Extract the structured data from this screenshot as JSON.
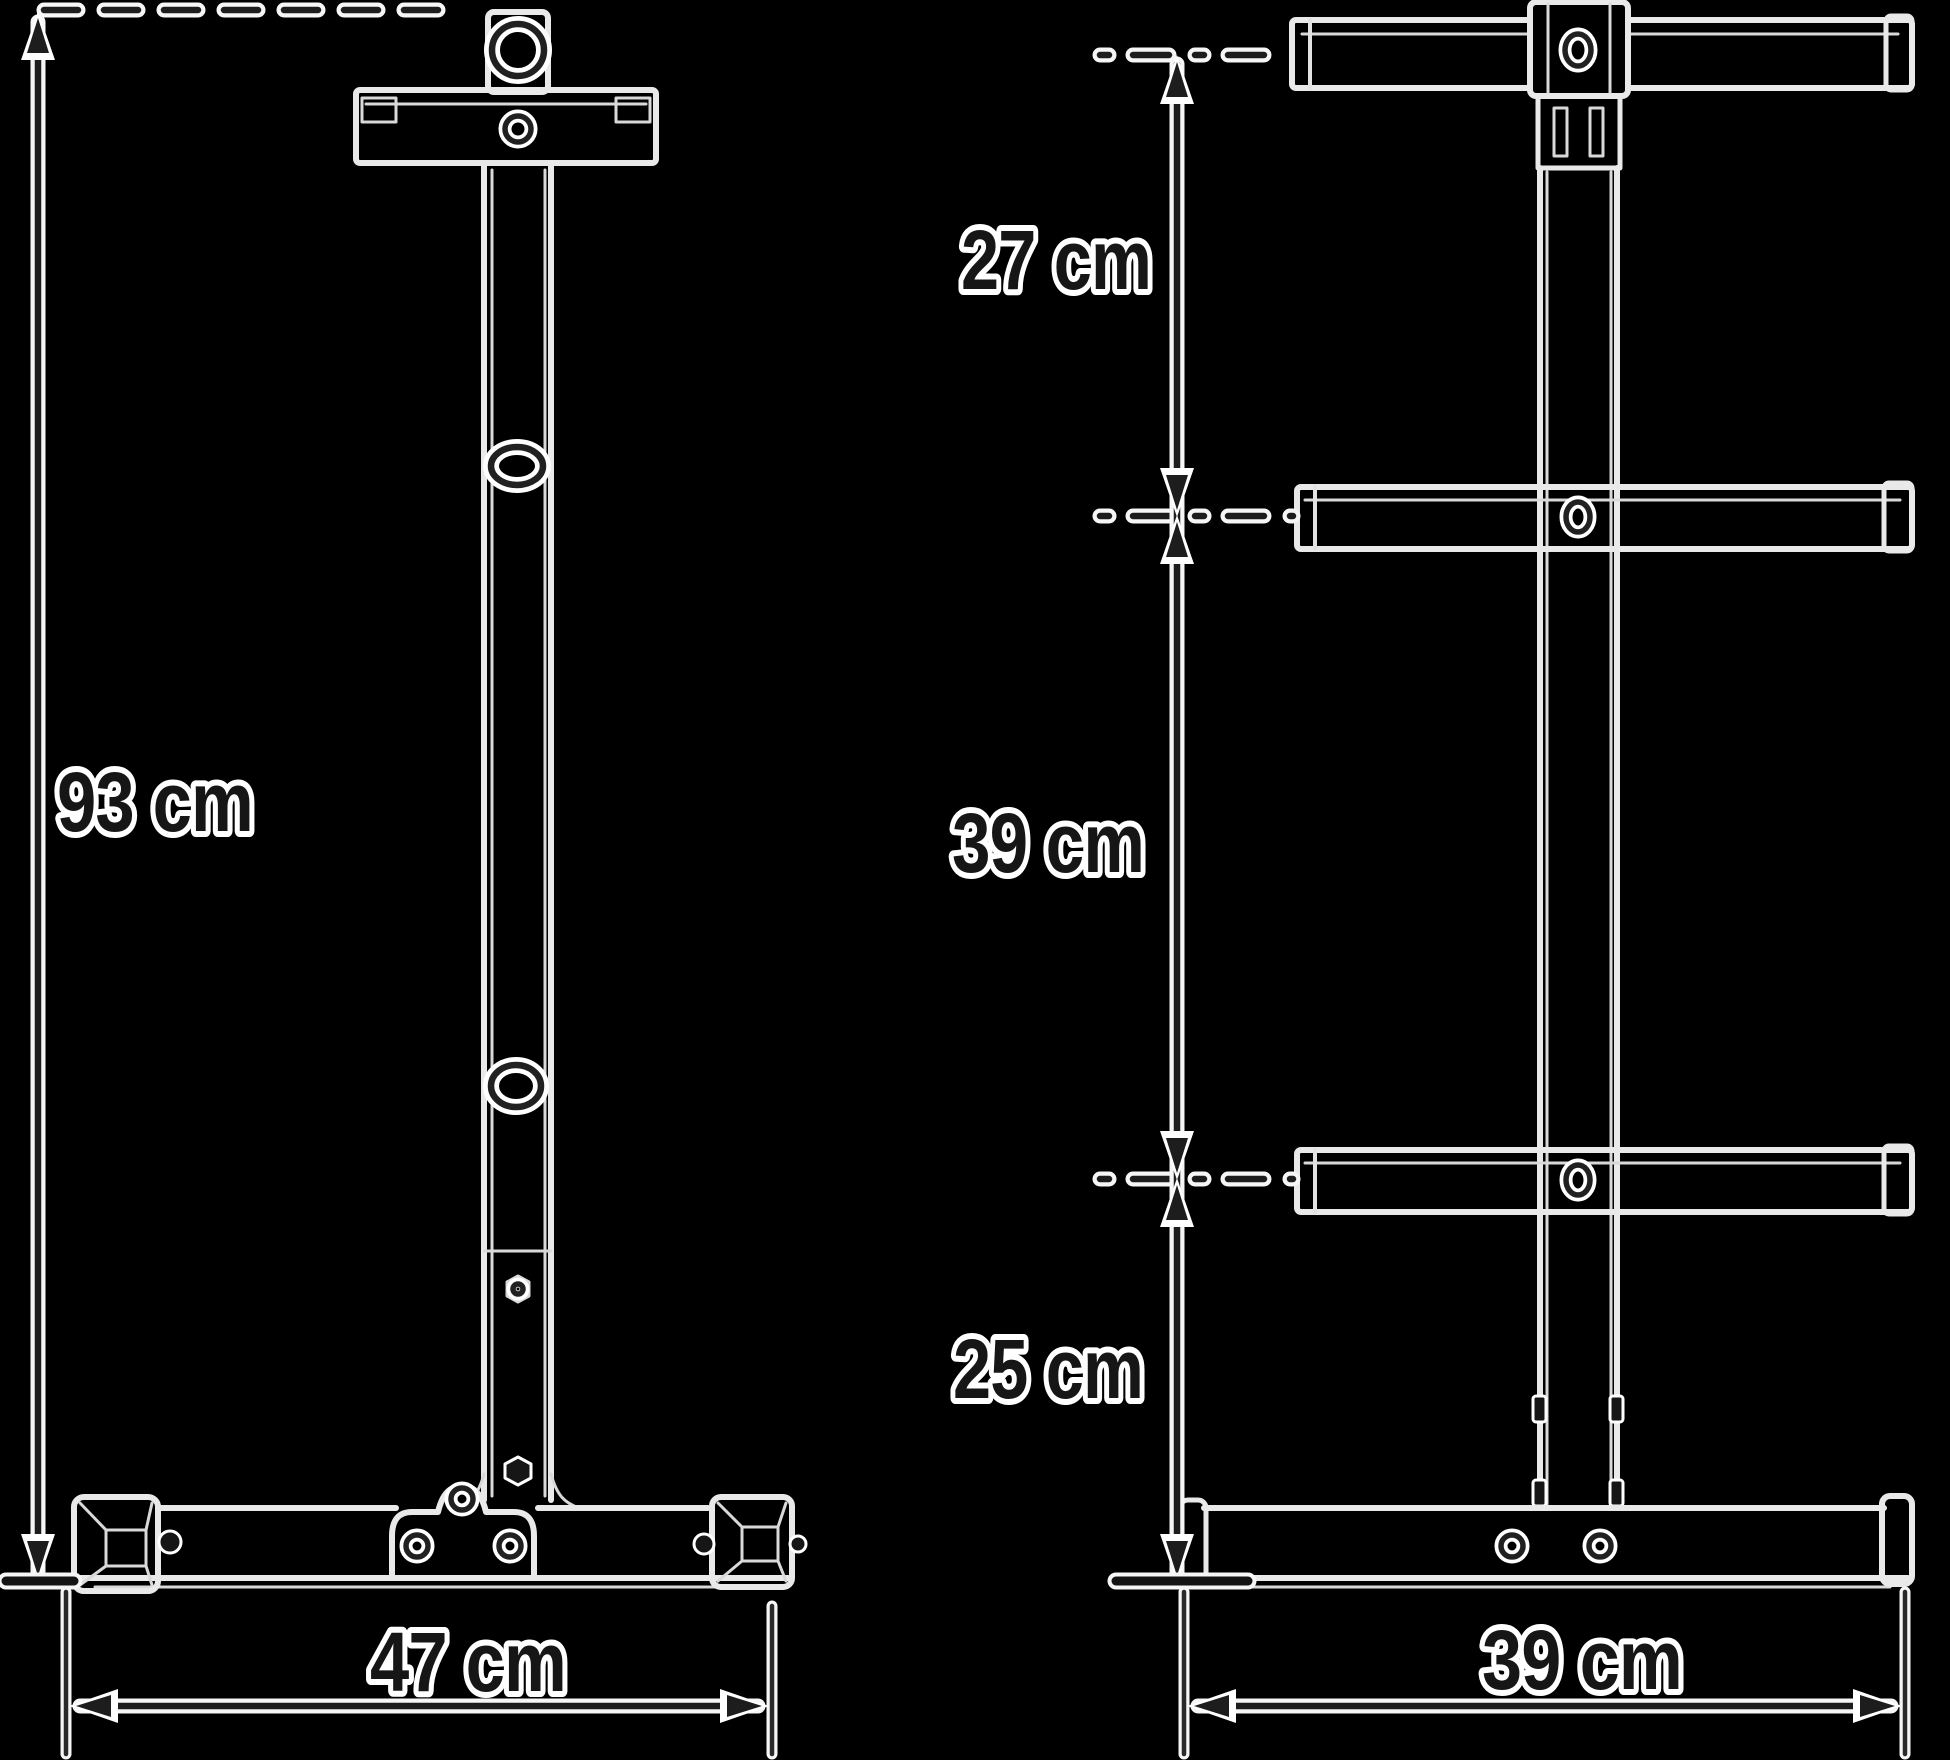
{
  "diagram": {
    "type": "technical-drawing",
    "subject": "weight plate tree - front and side views with dimensions",
    "colors": {
      "background": "#000000",
      "structure_line": "#e9e9e9",
      "dimension_line": "#1d1d1d",
      "halo": "#ffffff"
    },
    "front_view": {
      "name": "front view",
      "height": {
        "label": "93 cm"
      },
      "width": {
        "label": "47 cm"
      }
    },
    "side_view": {
      "name": "side view",
      "spacing_top": {
        "label": "27 cm"
      },
      "spacing_middle": {
        "label": "39 cm"
      },
      "spacing_bottom": {
        "label": "25 cm"
      },
      "depth": {
        "label": "39 cm"
      }
    }
  }
}
